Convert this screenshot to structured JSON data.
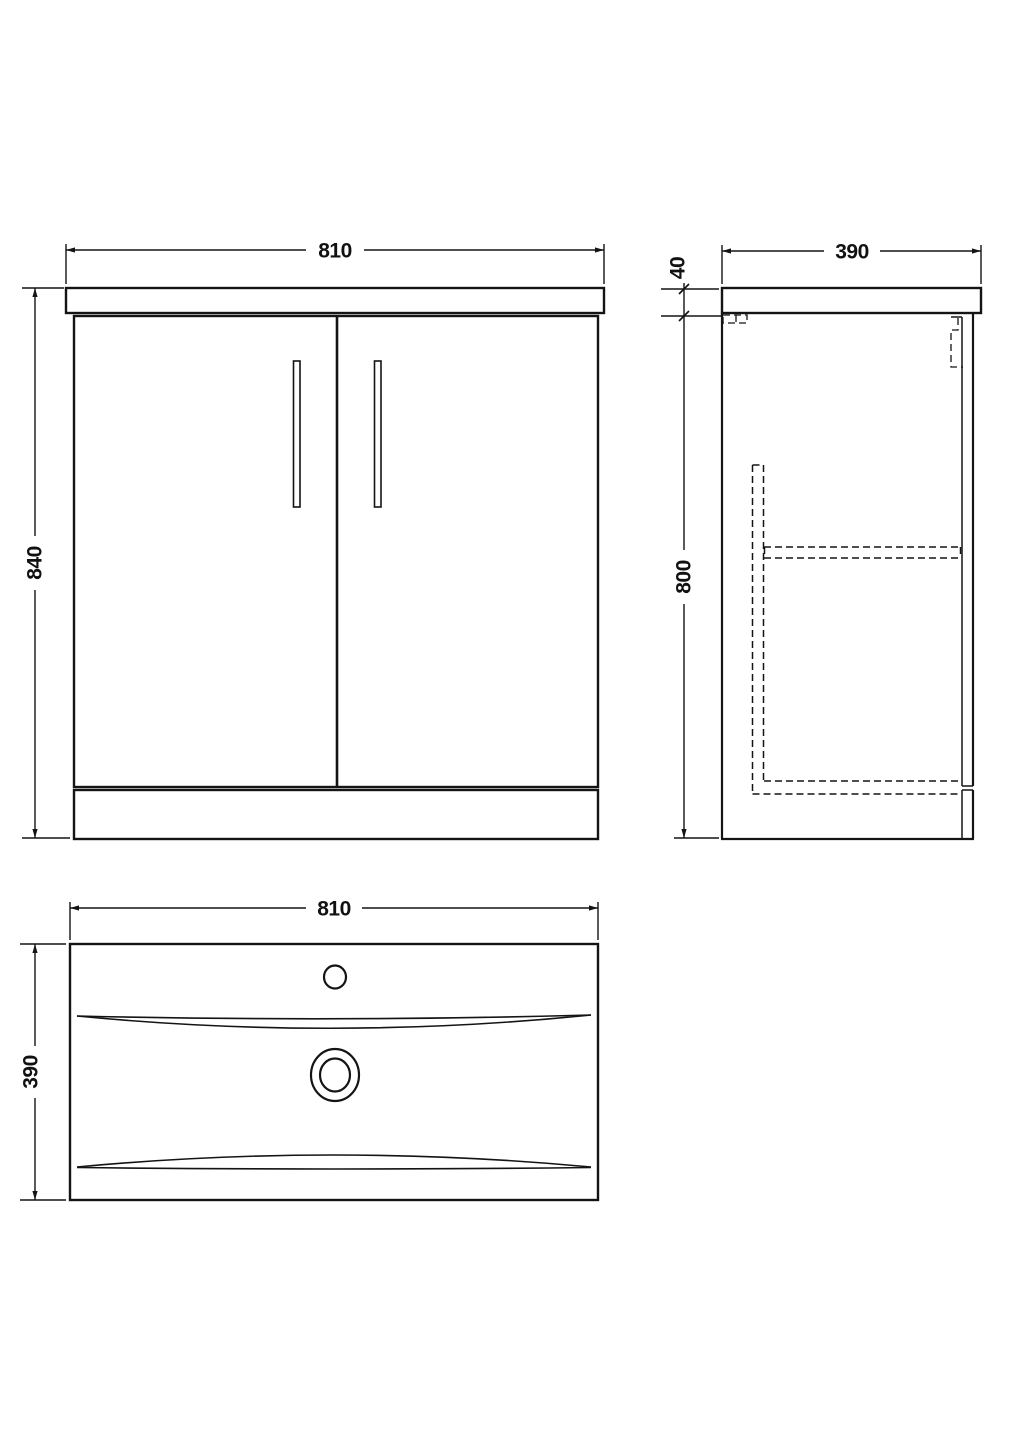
{
  "drawing": {
    "front_view": {
      "width_label": "810",
      "height_label": "840"
    },
    "side_view": {
      "depth_label": "390",
      "worktop_thickness_label": "40",
      "cabinet_height_label": "800"
    },
    "plan_view": {
      "width_label": "810",
      "depth_label": "390"
    }
  },
  "colors": {
    "line": "#141414",
    "background": "#ffffff"
  }
}
